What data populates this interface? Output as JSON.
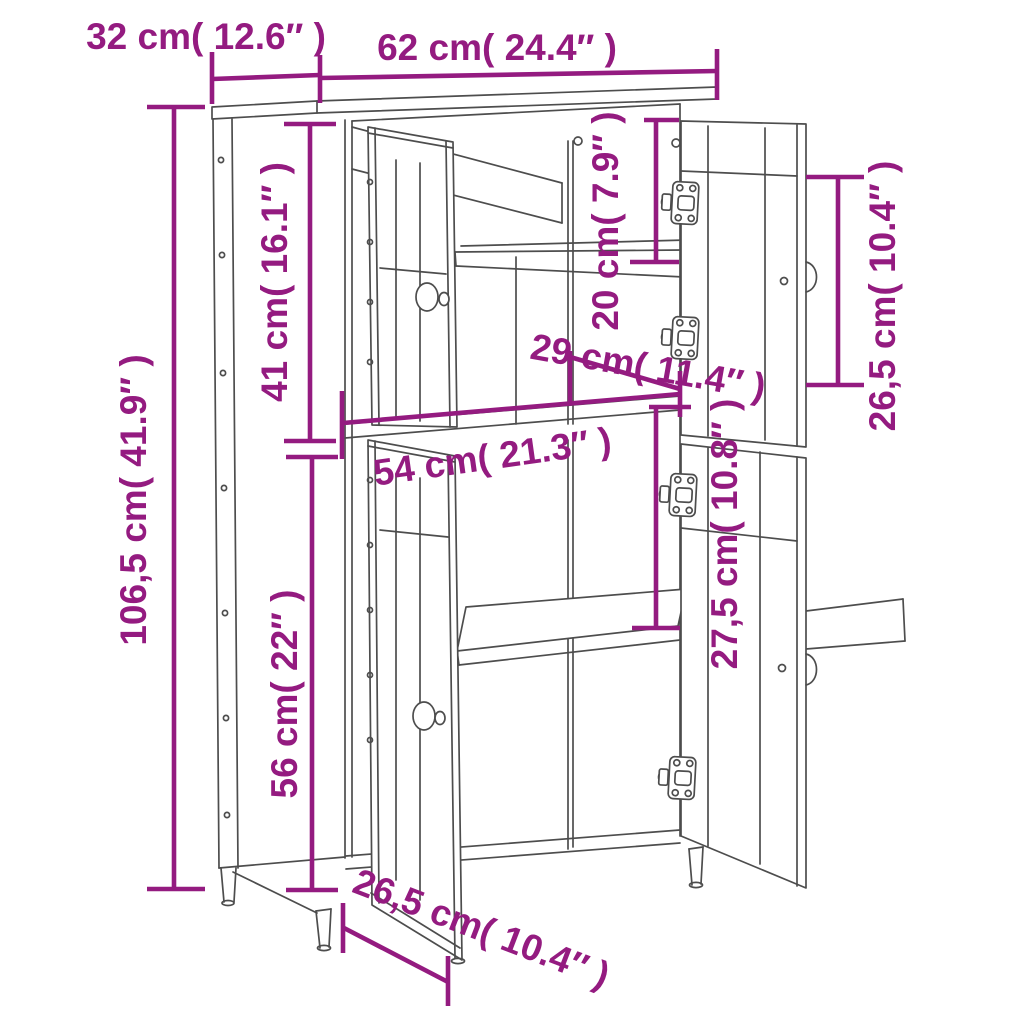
{
  "diagram": {
    "kind": "furniture-dimension-diagram",
    "product": "highboard-cabinet-4-doors-open",
    "background": "#ffffff",
    "accent_color": "#941b80",
    "line_color": "#4d4d4d"
  },
  "dims": {
    "depth_top": "32 cm( 12.6″ )",
    "width_top": "62 cm( 24.4″ )",
    "total_height": "106,5 cm( 41.9″ )",
    "upper_section_height": "41 cm( 16.1″ )",
    "lower_section_height": "56 cm( 22″ )",
    "upper_shelf_gap": "20 cm( 7.9″ )",
    "upper_inner_width": "29 cm( 11.4″ )",
    "upper_door_height": "26,5 cm( 10.4″ )",
    "inner_width": "54 cm( 21.3″ )",
    "lower_shelf_gap": "27,5 cm( 10.8″ )",
    "lower_door_width": "26,5 cm( 10.4″ )"
  }
}
